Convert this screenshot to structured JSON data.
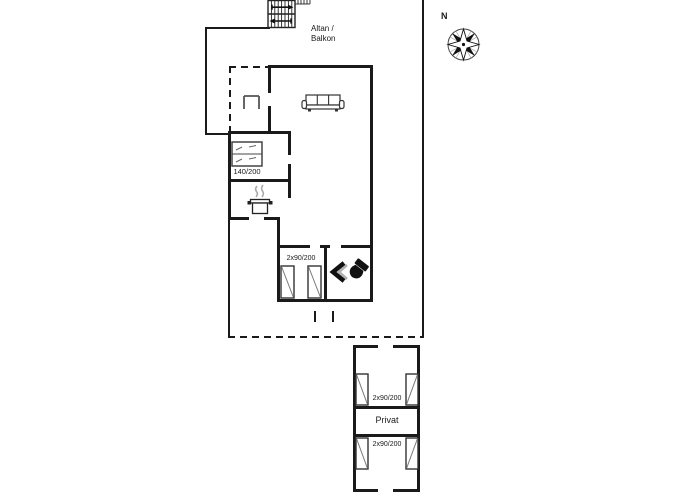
{
  "title": "Holiday home floor plan",
  "colors": {
    "walls": "#1a1a1a",
    "furniture_outline": "#444444",
    "furniture_light": "#999999",
    "background": "#ffffff"
  },
  "compass": {
    "north_label": "N"
  },
  "balcony": {
    "label_line1": "Altan /",
    "label_line2": "Balkon"
  },
  "main_building": {
    "bedroom1": {
      "bed_label": "140/200"
    },
    "bedroom2": {
      "bed_label": "2x90/200"
    }
  },
  "annex": {
    "room_top": {
      "bed_label": "2x90/200"
    },
    "room_middle": {
      "label": "Privat"
    },
    "room_bottom": {
      "bed_label": "2x90/200"
    }
  },
  "icons": {
    "stairs": "stairs-icon",
    "compass": "compass-rose-icon",
    "sofa": "sofa-icon",
    "stove": "cooking-pot-icon",
    "porch_furniture": "porch-furniture-icon",
    "shower": "shower-icon",
    "toilet": "toilet-icon",
    "double_bed": "double-bed-icon",
    "single_bed": "single-bed-icon"
  }
}
